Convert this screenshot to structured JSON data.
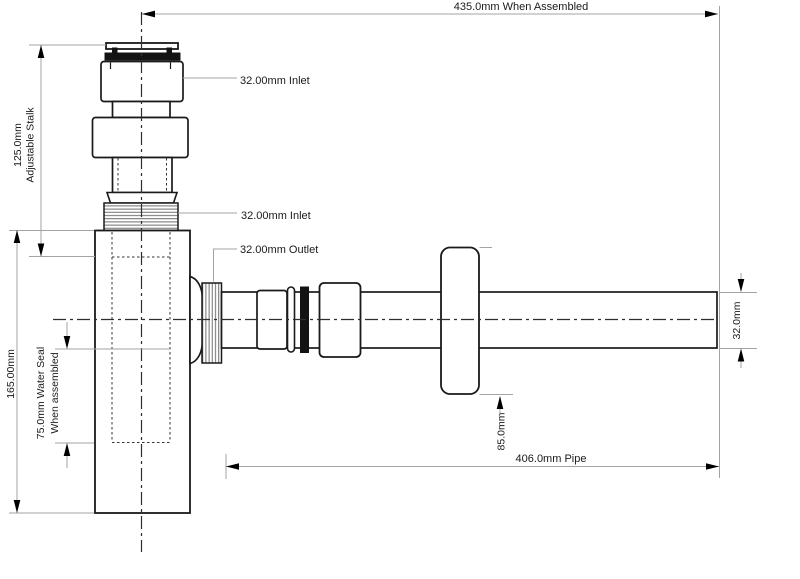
{
  "drawing": {
    "type": "technical-dimension-diagram",
    "subject": "bottle trap with adjustable stalk and outlet pipe",
    "dimensions": {
      "assembled_width": "435.0mm When Assembled",
      "stalk_value": "125.0mm",
      "stalk_caption": "Adjustable Stalk",
      "body_height": "165.00mm",
      "water_seal_line1": "75.0mm Water Seal",
      "water_seal_line2": "When assembled",
      "inlet_top": "32.00mm Inlet",
      "inlet_lower": "32.00mm Inlet",
      "outlet": "32.00mm Outlet",
      "flange_diameter": "85.0mm",
      "pipe_length": "406.0mm Pipe",
      "pipe_diameter": "32.0mm"
    },
    "colors": {
      "background": "#ffffff",
      "part_outline": "#1a1a1a",
      "dimension_line": "#a3a3a3",
      "arrowhead": "#000000",
      "seal_black": "#131313",
      "thread_hatch": "#6e6e6e",
      "centerline": "#2e2e2e"
    }
  }
}
